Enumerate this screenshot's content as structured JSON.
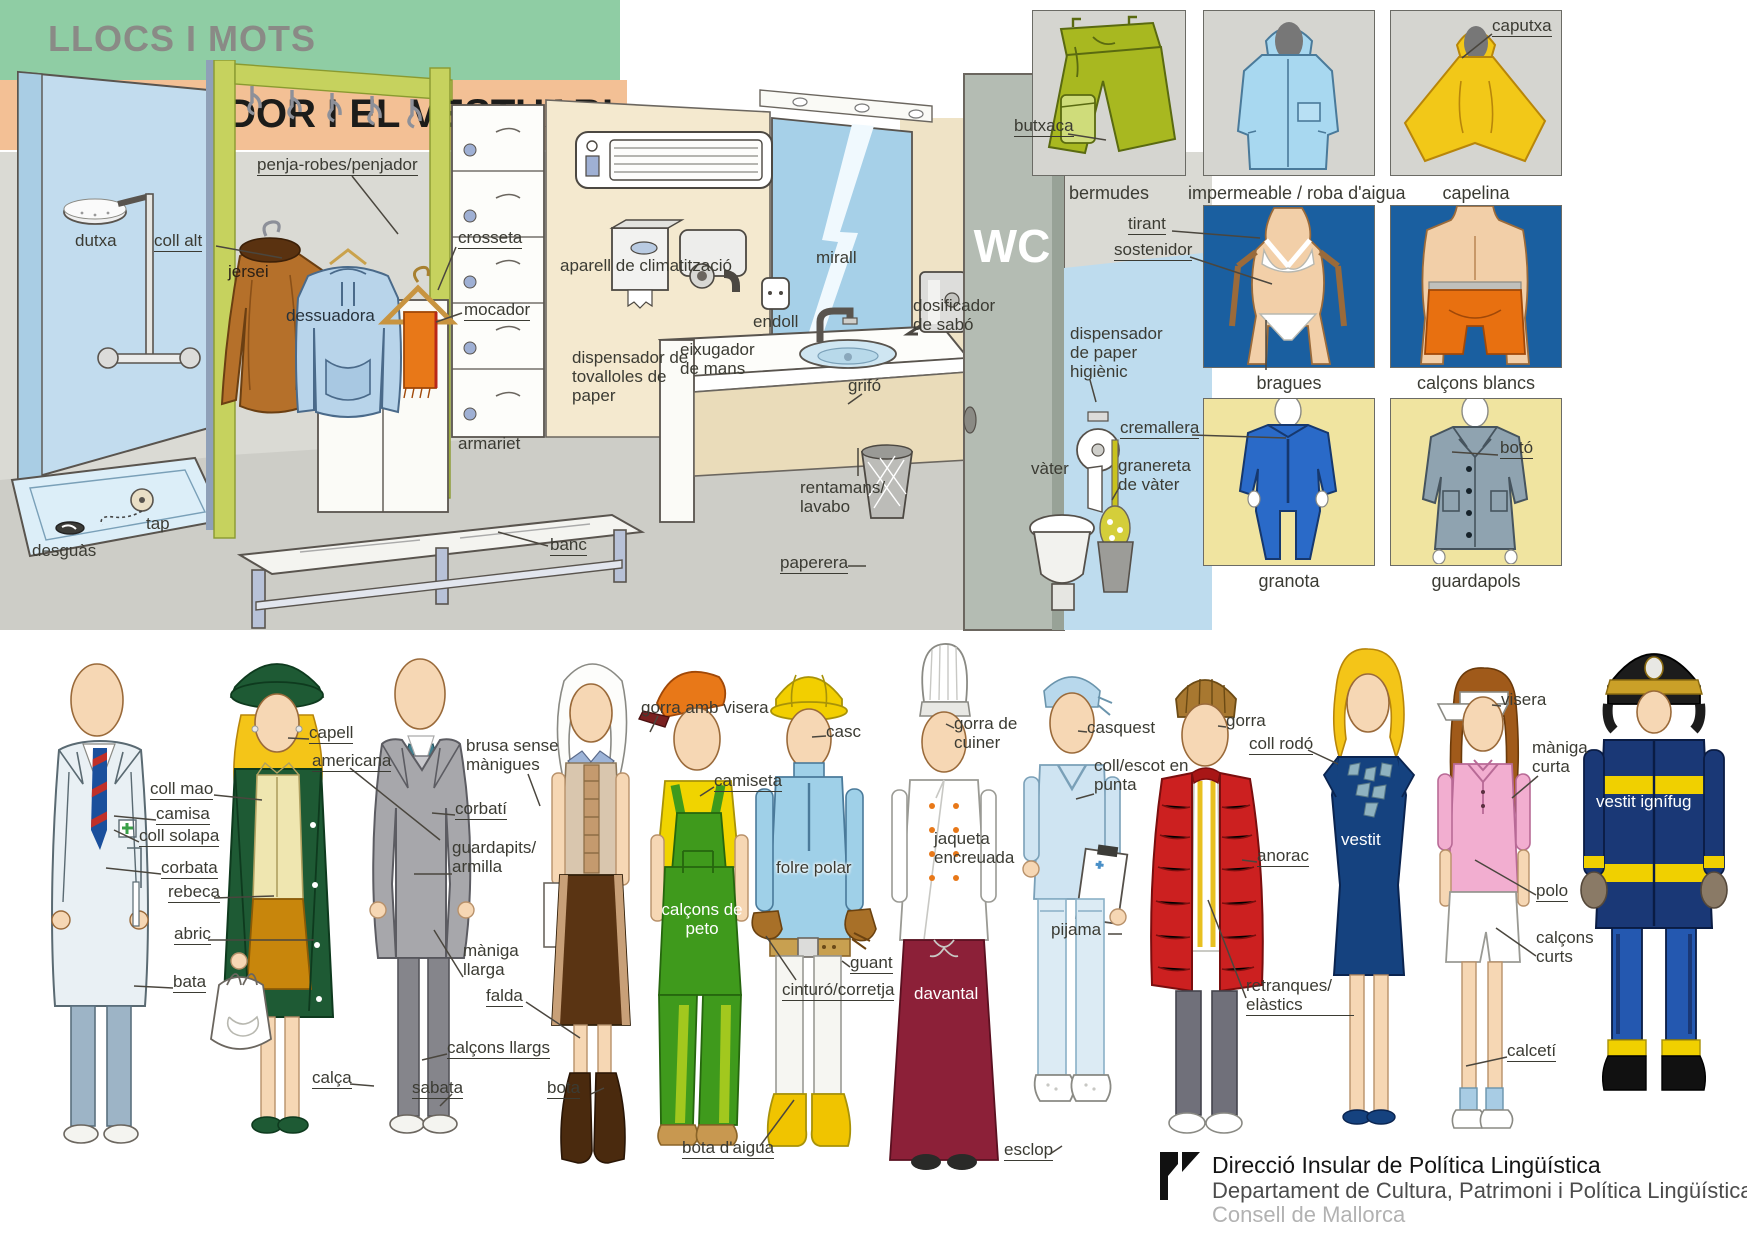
{
  "header": {
    "kicker": "LLOCS I MOTS",
    "title": "EL VESTIDOR I EL VESTUARI"
  },
  "colors": {
    "band_green": "#8fcda4",
    "band_peach": "#f3c095",
    "label_ink": "#3b3b33",
    "panel_blue_bg": "#1a5fa0",
    "panel_yellow_bg": "#f0e4a0",
    "panel_gray_bg": "#d5d5d0"
  },
  "s": {
    "dutxa": "dutxa",
    "coll_alt": "coll alt",
    "penja_robes": "penja-robes/penjador",
    "jersei": "jersei",
    "dessuadora": "dessuadora",
    "crosseta": "crosseta",
    "mocador": "mocador",
    "armariet": "armariet",
    "tap": "tap",
    "desguas": "desguàs",
    "banc": "banc",
    "aparell": "aparell de climatització",
    "disp_tovalloles": "dispensador de tovalloles de paper",
    "eixugador": "eixugador de mans",
    "endoll": "endoll",
    "mirall": "mirall",
    "grifo": "grifó",
    "dosificador": "dosificador de sabó",
    "rentamans": "rentamans/ lavabo",
    "paperera": "paperera",
    "vater": "vàter",
    "disp_paper_higienic": "dispensador de paper higiènic",
    "granereta": "granereta de vàter",
    "wc": "WC"
  },
  "panels": {
    "captions": {
      "bermudes": "bermudes",
      "impermeable": "impermeable / roba d'aigua",
      "capelina": "capelina",
      "bragues": "bragues",
      "calcons_blancs": "calçons blancs",
      "granota": "granota",
      "guardapols": "guardapols"
    },
    "parts": {
      "butxaca": "butxaca",
      "caputxa": "caputxa",
      "tirant": "tirant",
      "sostenidor": "sostenidor",
      "cremallera": "cremallera",
      "boto": "botó"
    }
  },
  "p": {
    "coll_mao": "coll mao",
    "camisa": "camisa",
    "coll_solapa": "coll solapa",
    "corbata": "corbata",
    "rebeca": "rebeca",
    "abric": "abric",
    "bata": "bata",
    "capell": "capell",
    "americana": "americana",
    "calca": "calça",
    "corbati": "corbatí",
    "guardapits": "guardapits/ armilla",
    "maniga_llarga": "màniga llarga",
    "brusa": "brusa sense mànigues",
    "falda": "falda",
    "calcons_llargs": "calçons llargs",
    "sabata": "sabata",
    "bota": "bota",
    "gorra_visera": "gorra amb visera",
    "camiseta": "camiseta",
    "calcons_peto": "calçons de peto",
    "casc": "casc",
    "folre_polar": "folre polar",
    "guant": "guant",
    "cinturo": "cinturó/corretja",
    "bota_aigua": "bota d'aigua",
    "gorra_cuiner": "gorra de cuiner",
    "jaqueta": "jaqueta encreuada",
    "davantal": "davantal",
    "casquest": "casquest",
    "coll_escot": "coll/escot en punta",
    "pijama": "pijama",
    "esclop": "esclop",
    "gorra": "gorra",
    "anorac": "anorac",
    "retranques": "retranques/ elàstics",
    "coll_rodo": "coll rodó",
    "vestit": "vestit",
    "visera": "visera",
    "maniga_curta": "màniga curta",
    "polo": "polo",
    "calcons_curts": "calçons curts",
    "calceti": "calcetí",
    "vestit_ignifug": "vestit ignífug"
  },
  "footer": {
    "line1": "Direcció Insular de Política Lingüística",
    "line2": "Departament de Cultura, Patrimoni i Política Lingüística",
    "line3": "Consell de Mallorca"
  }
}
